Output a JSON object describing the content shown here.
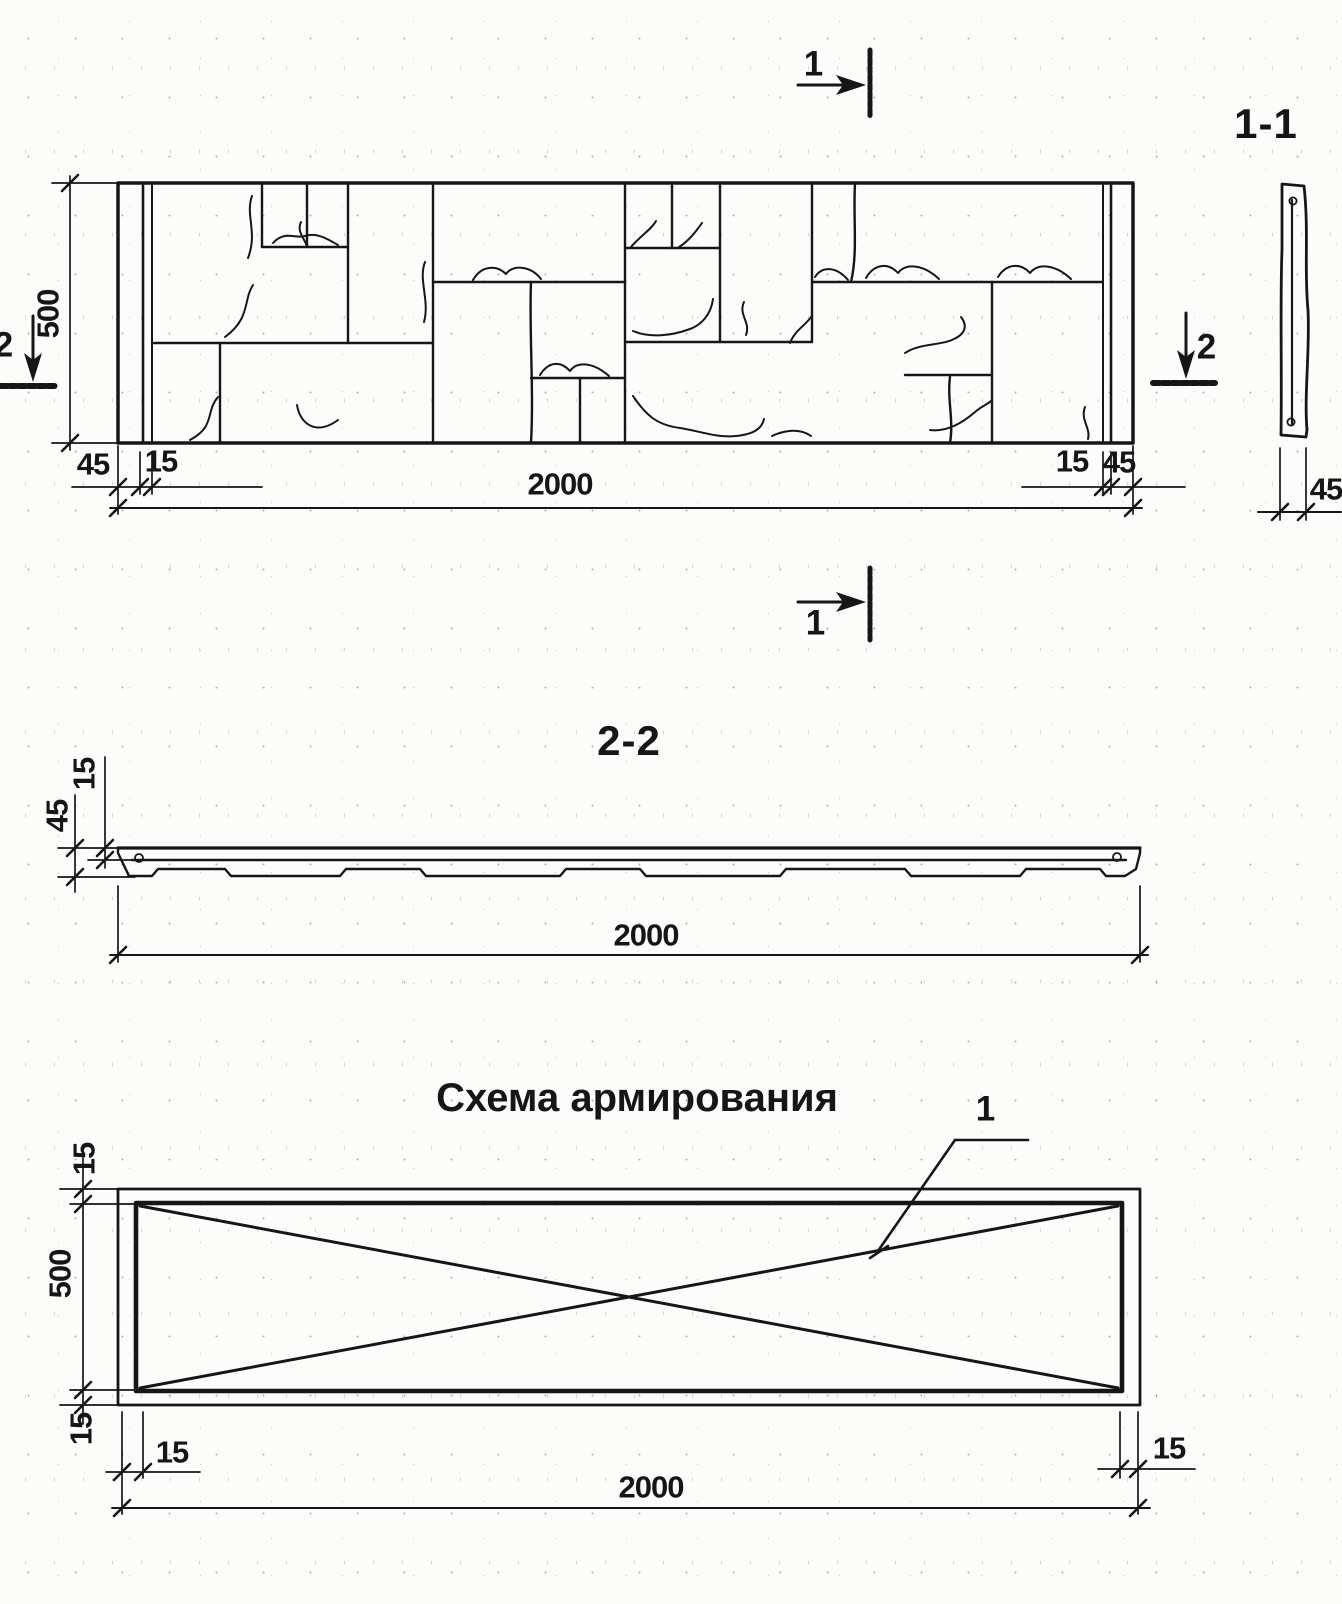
{
  "sheet": {
    "line_color": "#161616",
    "views": {
      "elevation": {
        "dims": {
          "height": "500",
          "width": "2000",
          "edge_left": "45",
          "joint_left": "15",
          "joint_right": "15",
          "edge_right": "45"
        },
        "section_marks": {
          "top": "1",
          "bottom": "1",
          "left": "2",
          "right": "2"
        }
      },
      "section_1_1": {
        "title": "1-1",
        "dims": {
          "thickness": "45"
        }
      },
      "section_2_2": {
        "title": "2-2",
        "dims": {
          "facing": "15",
          "thickness": "45",
          "width": "2000"
        }
      },
      "reinforcement": {
        "title": "Схема армирования",
        "callout": "1",
        "dims": {
          "cover_top": "15",
          "height": "500",
          "cover_bottom": "15",
          "cover_left": "15",
          "cover_right": "15",
          "width": "2000"
        }
      }
    }
  }
}
